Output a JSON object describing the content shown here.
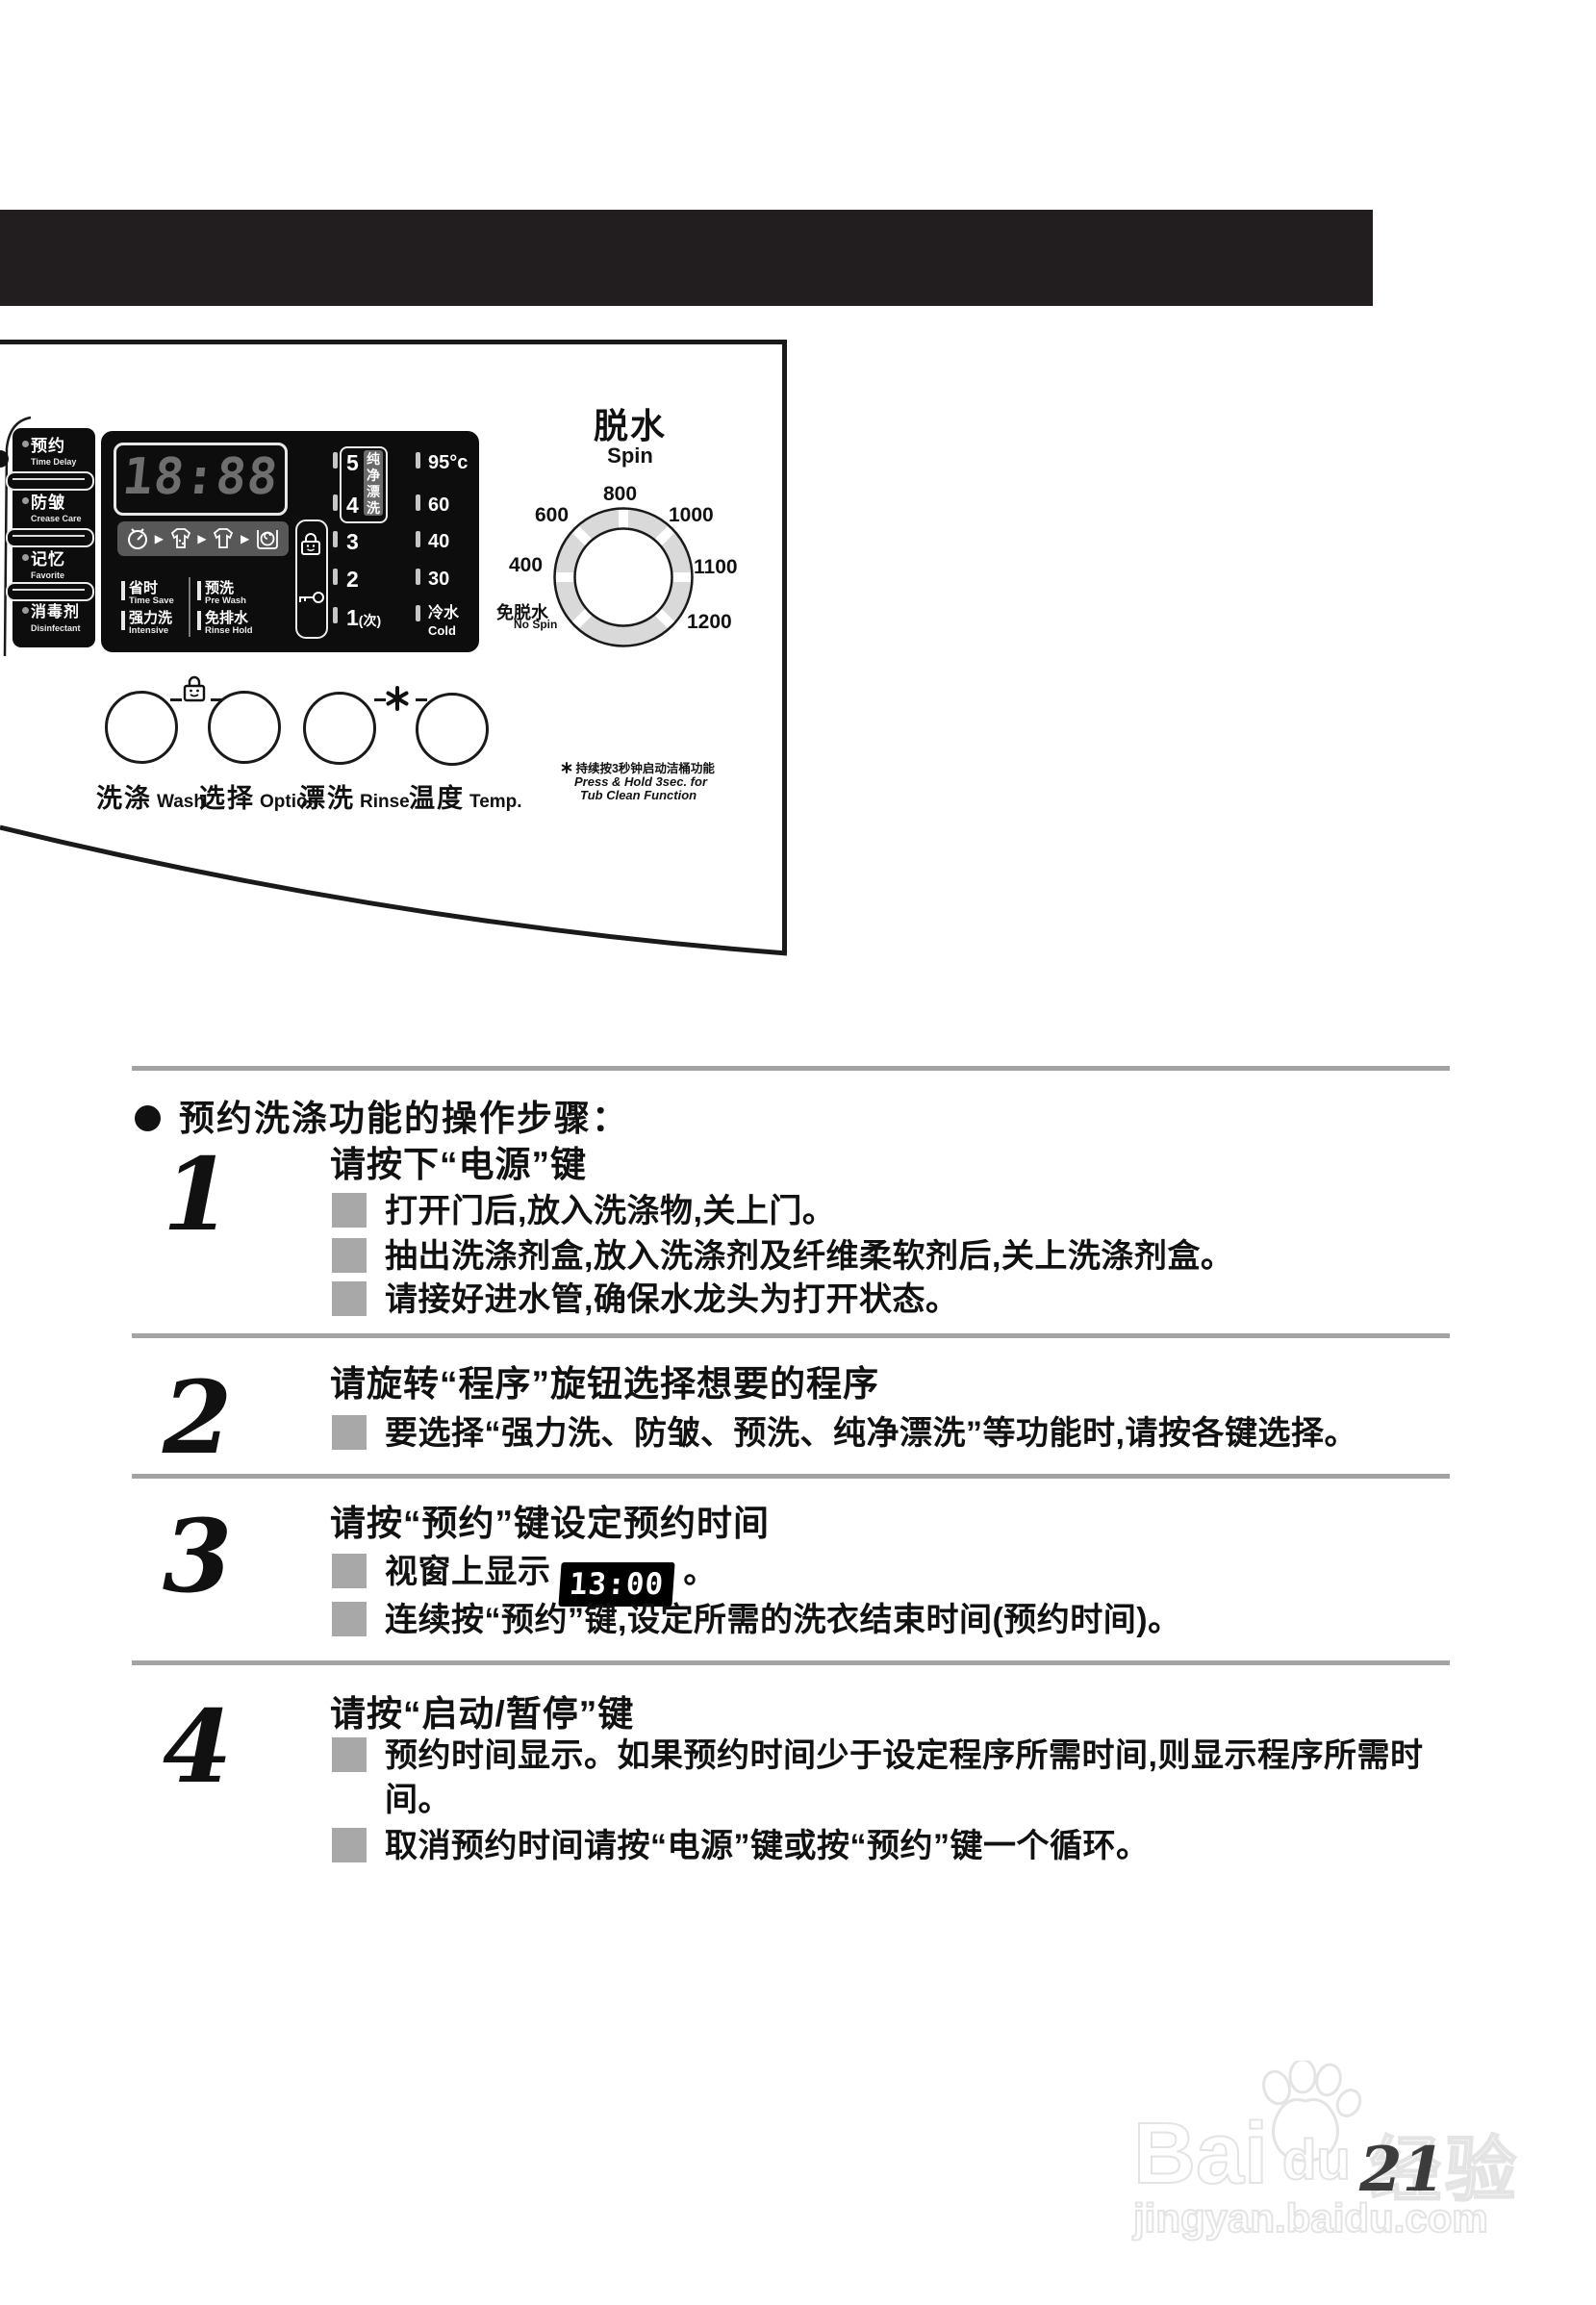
{
  "page": {
    "number": "21"
  },
  "panel": {
    "side_buttons": [
      {
        "zh": "预约",
        "en": "Time Delay"
      },
      {
        "zh": "防皱",
        "en": "Crease Care"
      },
      {
        "zh": "记忆",
        "en": "Favorite"
      },
      {
        "zh": "消毒剂",
        "en": "Disinfectant"
      }
    ],
    "display_time": "18:88",
    "rinse": {
      "levels": [
        "5",
        "4",
        "3",
        "2"
      ],
      "level_last": "1",
      "level_last_suffix": "(次)",
      "vertical_label": "纯净漂洗"
    },
    "temps": [
      "95°c",
      "60",
      "40",
      "30"
    ],
    "temp_last": {
      "zh": "冷水",
      "en": "Cold"
    },
    "options": [
      {
        "zh": "省时",
        "en": "Time Save"
      },
      {
        "zh": "强力洗",
        "en": "Intensive"
      },
      {
        "zh": "预洗",
        "en": "Pre Wash"
      },
      {
        "zh": "免排水",
        "en": "Rinse Hold"
      }
    ],
    "buttons": [
      {
        "zh": "洗涤",
        "en": "Wash"
      },
      {
        "zh": "选择",
        "en": "Option"
      },
      {
        "zh": "漂洗",
        "en": "Rinse"
      },
      {
        "zh": "温度",
        "en": "Temp."
      }
    ],
    "note": {
      "zh": "持续按3秒钟启动洁桶功能",
      "en1": "Press & Hold 3sec. for",
      "en2": "Tub Clean Function"
    },
    "spin": {
      "title": "脱水",
      "subtitle": "Spin",
      "labels": [
        "800",
        "600",
        "1000",
        "400",
        "1100",
        "1200"
      ],
      "no_spin_zh": "免脱水",
      "no_spin_en": "No Spin"
    },
    "colors": {
      "panel_black": "#0d0d0d",
      "icon_row_gray": "#585858",
      "dial_ring_gray": "#d9d9d9"
    }
  },
  "instructions": {
    "heading": "预约洗涤功能的操作步骤：",
    "steps": [
      {
        "num": "1",
        "title": "请按下“电源”键",
        "bullets": [
          "打开门后,放入洗涤物,关上门。",
          "抽出洗涤剂盒,放入洗涤剂及纤维柔软剂后,关上洗涤剂盒。",
          "请接好进水管,确保水龙头为打开状态。"
        ]
      },
      {
        "num": "2",
        "title": "请旋转“程序”旋钮选择想要的程序",
        "bullets": [
          "要选择“强力洗、防皱、预洗、纯净漂洗”等功能时,请按各键选择。"
        ]
      },
      {
        "num": "3",
        "title": "请按“预约”键设定预约时间",
        "bullets": [
          "视窗上显示",
          "连续按“预约”键,设定所需的洗衣结束时间(预约时间)。"
        ],
        "display_value": "13:00",
        "after_display": "。"
      },
      {
        "num": "4",
        "title": "请按“启动/暂停”键",
        "bullets": [
          "预约时间显示。如果预约时间少于设定程序所需时间,则显示程序所需时间。",
          "取消预约时间请按“电源”键或按“预约”键一个循环。"
        ]
      }
    ]
  },
  "watermark": {
    "brand_left": "Bai",
    "brand_right": "du",
    "brand_cn": "经验",
    "domain": "jingyan.baidu.com"
  }
}
